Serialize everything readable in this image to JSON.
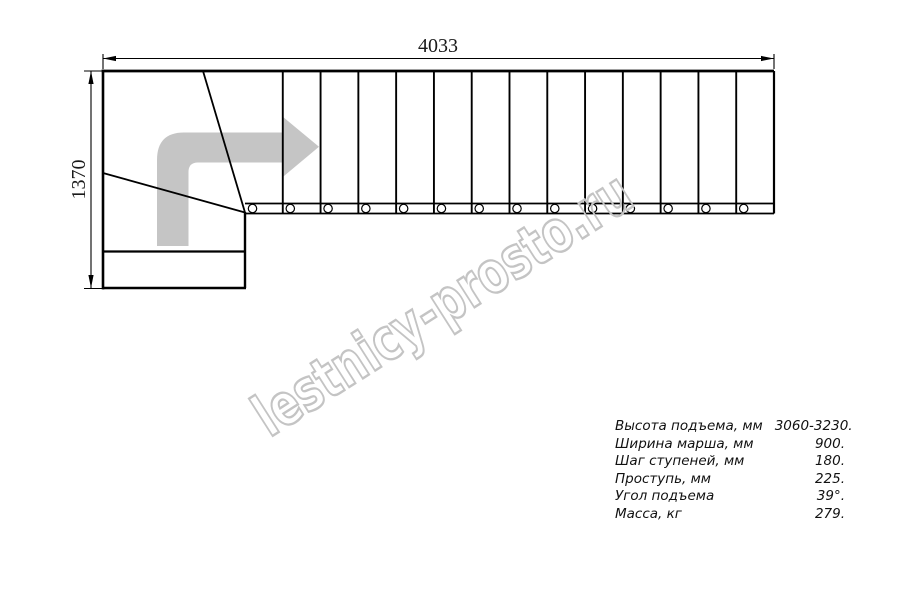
{
  "drawing": {
    "dim_width_label": "4033",
    "dim_height_label": "1370",
    "flight_steps": 14
  },
  "watermark": {
    "text": "lestnicy-prosto.ru"
  },
  "specs": {
    "rows": [
      {
        "label": "Высота подъема, мм",
        "value": "3060-3230."
      },
      {
        "label": "Ширина марша, мм",
        "value": "900."
      },
      {
        "label": "Шаг ступеней, мм",
        "value": "180."
      },
      {
        "label": "Проступь, мм",
        "value": "225."
      },
      {
        "label": "Угол подъема",
        "value": "39°."
      },
      {
        "label": "Масса, кг",
        "value": "279."
      }
    ]
  },
  "colors": {
    "line": "#000000",
    "direction_arrow": "#c5c5c5",
    "watermark": "#c4c4c4"
  }
}
